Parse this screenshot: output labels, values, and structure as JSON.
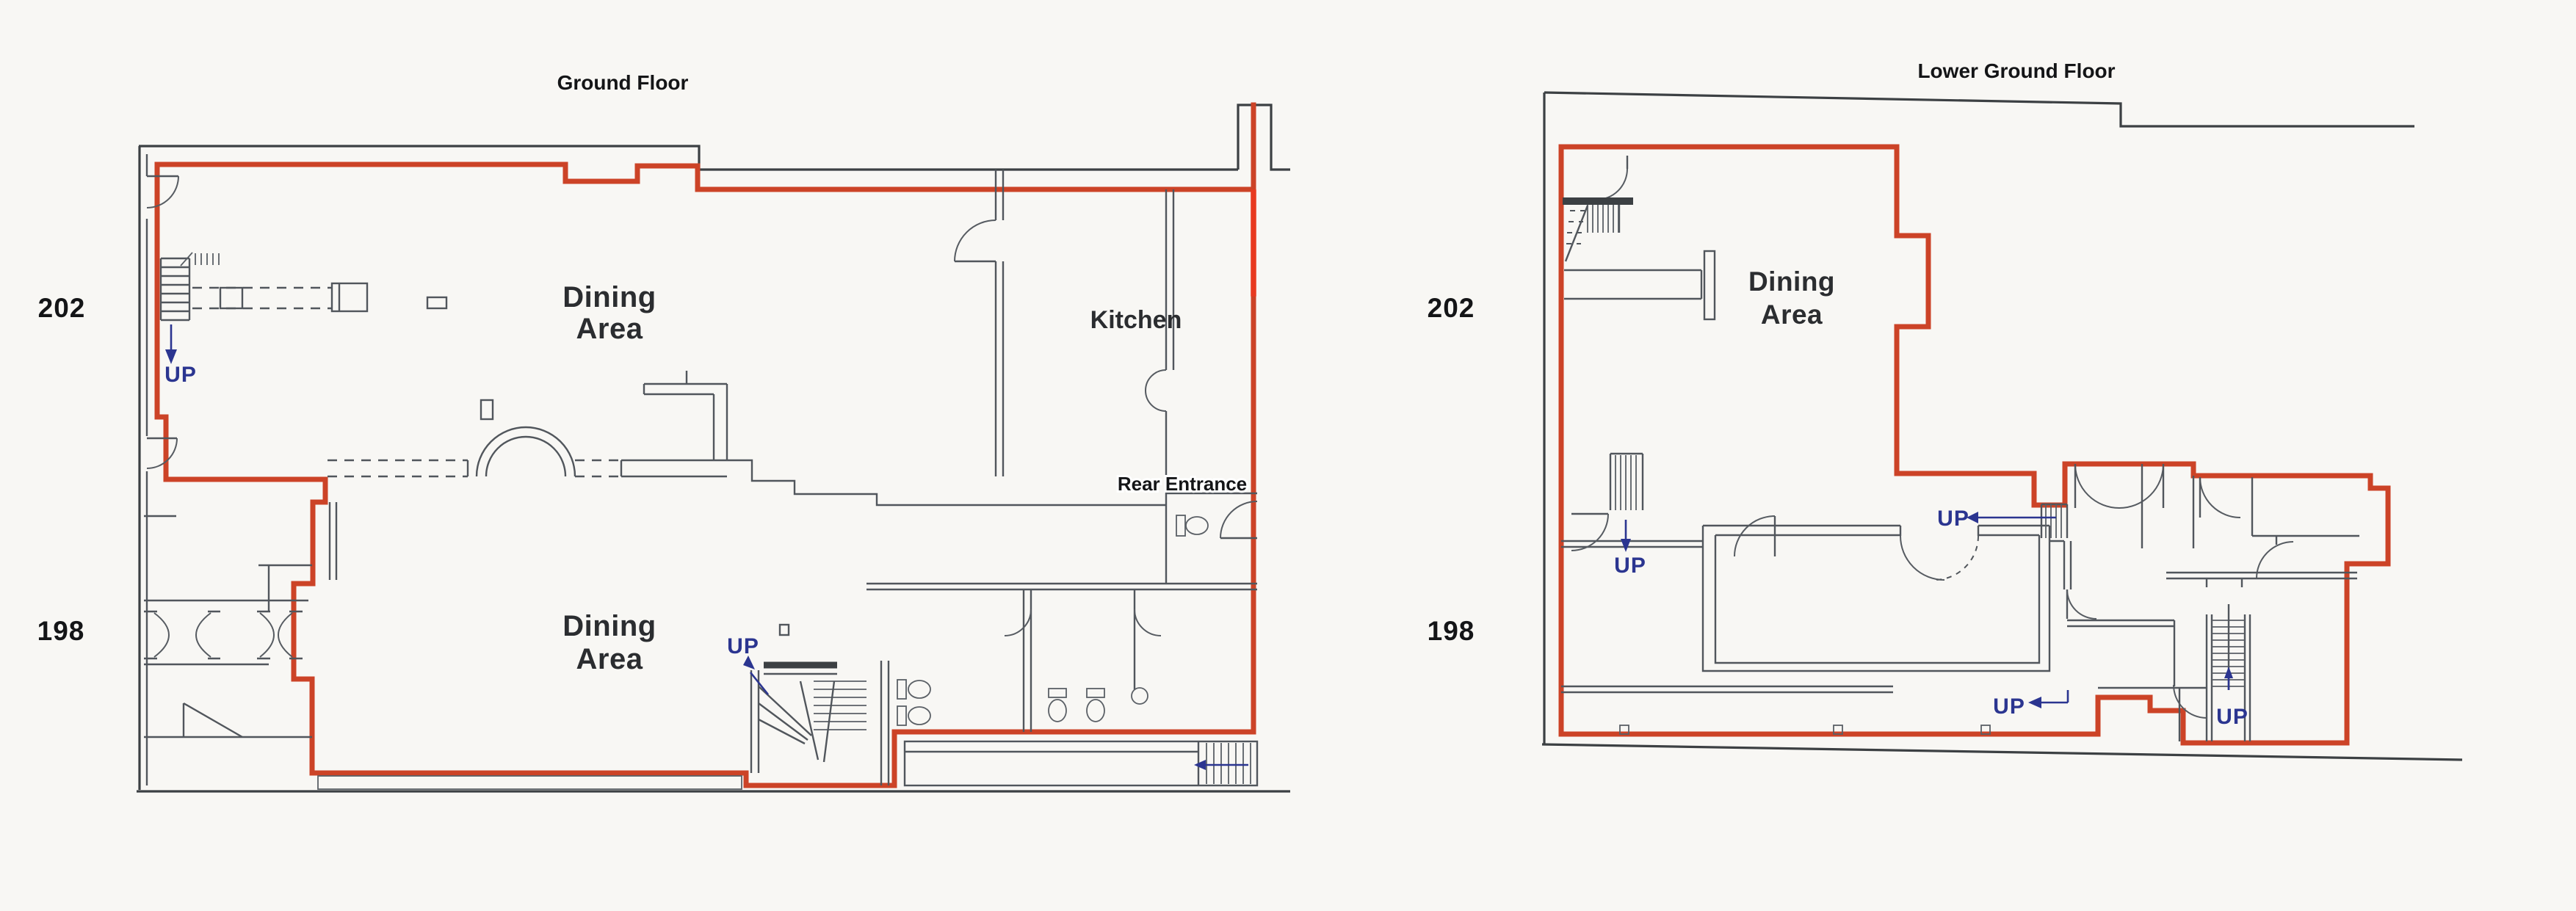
{
  "document": {
    "kind": "scanned floor plan drawing",
    "background": "#f8f7f4"
  },
  "colors": {
    "demise_boundary_red": "#cc4327",
    "bright_red_segment": "#e83a20",
    "outer_wall_dark": "#3c4043",
    "inner_wall_gray": "#51565c",
    "up_arrow_blue": "#2b3590",
    "label_black": "#141517"
  },
  "left_plan": {
    "title": "Ground Floor",
    "number_upper": "202",
    "number_lower": "198",
    "dining_upper": [
      "Dining",
      "Area"
    ],
    "dining_lower": [
      "Dining",
      "Area"
    ],
    "kitchen": "Kitchen",
    "rear_entrance": "Rear Entrance",
    "up": [
      "UP",
      "UP"
    ]
  },
  "right_plan": {
    "title": "Lower Ground Floor",
    "number_upper": "202",
    "number_lower": "198",
    "dining": [
      "Dining",
      "Area"
    ],
    "up": [
      "UP",
      "UP",
      "UP",
      "UP"
    ]
  }
}
